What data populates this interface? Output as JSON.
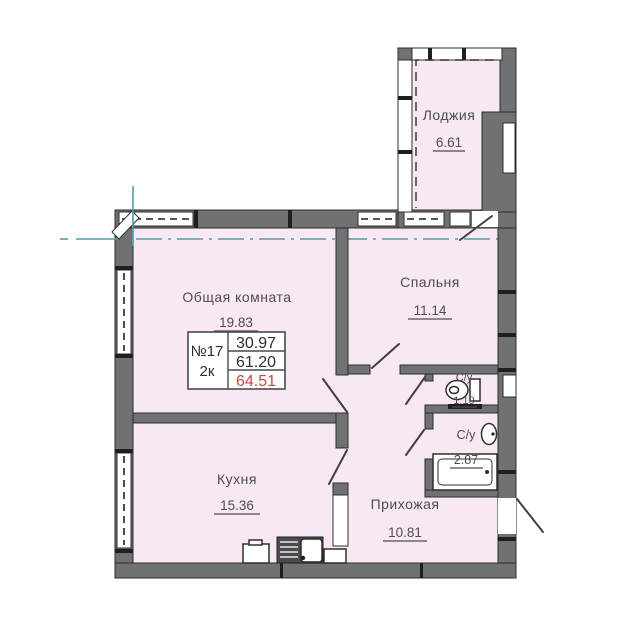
{
  "plan": {
    "rooms": {
      "loggia": {
        "name": "Лоджия",
        "area": "6.61"
      },
      "living": {
        "name": "Общая комната",
        "area": "19.83"
      },
      "bedroom": {
        "name": "Спальня",
        "area": "11.14"
      },
      "kitchen": {
        "name": "Кухня",
        "area": "15.36"
      },
      "hallway": {
        "name": "Прихожая",
        "area": "10.81"
      },
      "wc_small": {
        "name": "С/у",
        "area": "1.19"
      },
      "wc_big": {
        "name": "С/у",
        "area": "2.87"
      }
    },
    "info_table": {
      "unit_number": "№17",
      "unit_type": "2к",
      "values": [
        "30.97",
        "61.20",
        "64.51"
      ]
    },
    "colors": {
      "room_fill": "#f8e8f4",
      "wall": "#6f7173",
      "axis": "#4a9fa8",
      "highlight": "#cc4444",
      "ink": "#4d4d4d"
    }
  }
}
